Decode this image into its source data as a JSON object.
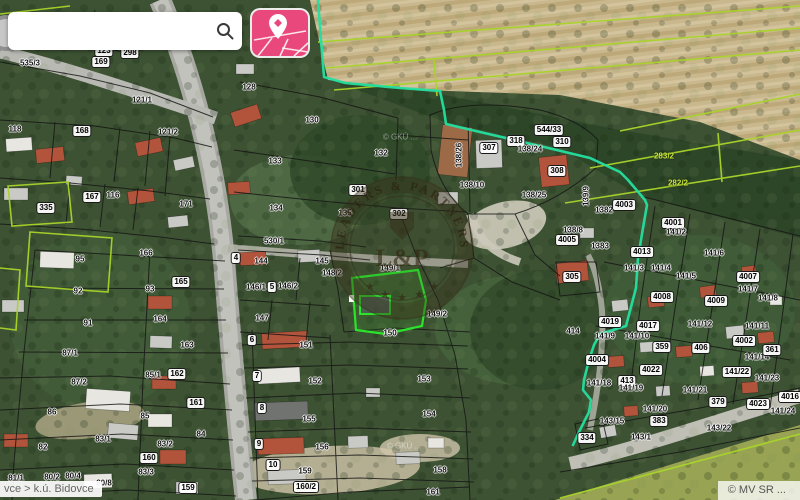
{
  "app": {
    "search": {
      "value": "",
      "icon": "magnifier"
    },
    "map_style_button": {
      "icon": "map-with-location-pin",
      "color": "#e9487d"
    }
  },
  "statusbar": {
    "breadcrumb": "vce > k.ú. Bidovce",
    "copyright": "© MV SR ..."
  },
  "watermark": {
    "arc_text": "LEADERS & PARTNERS",
    "monogram": "L&P",
    "stars": "★"
  },
  "map": {
    "colors": {
      "boundary_cyan": "#24dfa0",
      "field_lines_lime": "#a8d42a",
      "cadastral_black": "#141414",
      "selected_green": "#2be32b",
      "field_tan": "#c9b88e",
      "forest_green": "#2d4527",
      "road_gray": "#b9b9b3"
    },
    "building_colors": {
      "r": "#b2543b",
      "g": "#c9cac6",
      "d": "#70736f",
      "w": "#e7e6e0",
      "br": "#9c6a46"
    },
    "selected_parcel": {
      "label": "149/1"
    },
    "labels": [
      {
        "t": "123",
        "x": 104,
        "y": 51,
        "s": "p"
      },
      {
        "t": "298",
        "x": 130,
        "y": 53,
        "s": "p"
      },
      {
        "t": "169",
        "x": 101,
        "y": 62,
        "s": "p"
      },
      {
        "t": "535/3",
        "x": 30,
        "y": 63,
        "s": "h"
      },
      {
        "t": "128",
        "x": 249,
        "y": 87,
        "s": "h"
      },
      {
        "t": "121/1",
        "x": 142,
        "y": 100,
        "s": "h"
      },
      {
        "t": "118",
        "x": 15,
        "y": 129,
        "s": "h"
      },
      {
        "t": "168",
        "x": 82,
        "y": 131,
        "s": "p"
      },
      {
        "t": "121/2",
        "x": 168,
        "y": 132,
        "s": "h"
      },
      {
        "t": "130",
        "x": 312,
        "y": 120,
        "s": "h"
      },
      {
        "t": "132",
        "x": 381,
        "y": 153,
        "s": "h"
      },
      {
        "t": "133",
        "x": 275,
        "y": 161,
        "s": "h"
      },
      {
        "t": "167",
        "x": 92,
        "y": 197,
        "s": "p"
      },
      {
        "t": "116",
        "x": 113,
        "y": 195,
        "s": "h"
      },
      {
        "t": "335",
        "x": 46,
        "y": 208,
        "s": "p"
      },
      {
        "t": "171",
        "x": 186,
        "y": 204,
        "s": "h"
      },
      {
        "t": "301",
        "x": 358,
        "y": 190,
        "s": "p"
      },
      {
        "t": "302",
        "x": 399,
        "y": 214,
        "s": "p"
      },
      {
        "t": "95",
        "x": 80,
        "y": 259,
        "s": "h"
      },
      {
        "t": "166",
        "x": 146,
        "y": 253,
        "s": "h"
      },
      {
        "t": "92",
        "x": 78,
        "y": 291,
        "s": "h"
      },
      {
        "t": "93",
        "x": 150,
        "y": 289,
        "s": "h"
      },
      {
        "t": "165",
        "x": 181,
        "y": 282,
        "s": "p"
      },
      {
        "t": "164",
        "x": 160,
        "y": 319,
        "s": "h"
      },
      {
        "t": "91",
        "x": 88,
        "y": 323,
        "s": "h"
      },
      {
        "t": "163",
        "x": 187,
        "y": 345,
        "s": "h"
      },
      {
        "t": "87/1",
        "x": 70,
        "y": 353,
        "s": "h"
      },
      {
        "t": "85/1",
        "x": 153,
        "y": 375,
        "s": "h"
      },
      {
        "t": "162",
        "x": 177,
        "y": 374,
        "s": "p"
      },
      {
        "t": "87/2",
        "x": 79,
        "y": 382,
        "s": "h"
      },
      {
        "t": "86",
        "x": 52,
        "y": 412,
        "s": "h"
      },
      {
        "t": "85",
        "x": 145,
        "y": 416,
        "s": "h"
      },
      {
        "t": "161",
        "x": 196,
        "y": 403,
        "s": "p"
      },
      {
        "t": "82",
        "x": 43,
        "y": 447,
        "s": "h"
      },
      {
        "t": "83/1",
        "x": 103,
        "y": 439,
        "s": "h"
      },
      {
        "t": "83/2",
        "x": 165,
        "y": 444,
        "s": "h"
      },
      {
        "t": "84",
        "x": 201,
        "y": 434,
        "s": "h"
      },
      {
        "t": "160",
        "x": 149,
        "y": 458,
        "s": "p"
      },
      {
        "t": "81/1",
        "x": 16,
        "y": 478,
        "s": "h"
      },
      {
        "t": "80/2",
        "x": 52,
        "y": 477,
        "s": "h"
      },
      {
        "t": "80/4",
        "x": 73,
        "y": 476,
        "s": "h"
      },
      {
        "t": "80/8",
        "x": 104,
        "y": 483,
        "s": "h"
      },
      {
        "t": "83/3",
        "x": 146,
        "y": 472,
        "s": "h"
      },
      {
        "t": "159",
        "x": 188,
        "y": 488,
        "s": "p"
      },
      {
        "t": "134",
        "x": 276,
        "y": 208,
        "s": "h"
      },
      {
        "t": "135",
        "x": 345,
        "y": 213,
        "s": "h"
      },
      {
        "t": "530/1",
        "x": 274,
        "y": 241,
        "s": "h"
      },
      {
        "t": "144",
        "x": 261,
        "y": 261,
        "s": "h"
      },
      {
        "t": "145",
        "x": 322,
        "y": 261,
        "s": "h"
      },
      {
        "t": "4",
        "x": 236,
        "y": 258,
        "s": "p"
      },
      {
        "t": "5",
        "x": 272,
        "y": 287,
        "s": "p"
      },
      {
        "t": "148/2",
        "x": 332,
        "y": 273,
        "s": "h"
      },
      {
        "t": "146/1",
        "x": 256,
        "y": 287,
        "s": "h"
      },
      {
        "t": "146/2",
        "x": 288,
        "y": 286,
        "s": "h"
      },
      {
        "t": "147",
        "x": 262,
        "y": 318,
        "s": "h"
      },
      {
        "t": "149/1",
        "x": 390,
        "y": 268,
        "s": "h"
      },
      {
        "t": "149/2",
        "x": 437,
        "y": 314,
        "s": "h"
      },
      {
        "t": "150",
        "x": 390,
        "y": 333,
        "s": "h"
      },
      {
        "t": "151",
        "x": 306,
        "y": 345,
        "s": "h"
      },
      {
        "t": "152",
        "x": 315,
        "y": 381,
        "s": "h"
      },
      {
        "t": "153",
        "x": 424,
        "y": 379,
        "s": "h"
      },
      {
        "t": "155",
        "x": 309,
        "y": 419,
        "s": "h"
      },
      {
        "t": "154",
        "x": 429,
        "y": 414,
        "s": "h"
      },
      {
        "t": "156",
        "x": 322,
        "y": 447,
        "s": "h"
      },
      {
        "t": "159",
        "x": 305,
        "y": 471,
        "s": "h"
      },
      {
        "t": "158",
        "x": 440,
        "y": 470,
        "s": "h"
      },
      {
        "t": "160/2",
        "x": 306,
        "y": 487,
        "s": "p"
      },
      {
        "t": "161",
        "x": 433,
        "y": 492,
        "s": "h"
      },
      {
        "t": "6",
        "x": 252,
        "y": 340,
        "s": "p"
      },
      {
        "t": "7",
        "x": 257,
        "y": 376,
        "s": "p"
      },
      {
        "t": "8",
        "x": 262,
        "y": 408,
        "s": "p"
      },
      {
        "t": "9",
        "x": 259,
        "y": 444,
        "s": "p"
      },
      {
        "t": "10",
        "x": 273,
        "y": 465,
        "s": "p"
      },
      {
        "t": "138/26",
        "x": 459,
        "y": 155,
        "s": "v"
      },
      {
        "t": "307",
        "x": 489,
        "y": 148,
        "s": "p"
      },
      {
        "t": "318",
        "x": 516,
        "y": 141,
        "s": "p"
      },
      {
        "t": "544/33",
        "x": 549,
        "y": 130,
        "s": "p"
      },
      {
        "t": "138/24",
        "x": 530,
        "y": 149,
        "s": "h"
      },
      {
        "t": "310",
        "x": 562,
        "y": 142,
        "s": "p"
      },
      {
        "t": "308",
        "x": 557,
        "y": 171,
        "s": "p"
      },
      {
        "t": "138/10",
        "x": 472,
        "y": 185,
        "s": "h"
      },
      {
        "t": "138/25",
        "x": 534,
        "y": 195,
        "s": "h"
      },
      {
        "t": "139/9",
        "x": 586,
        "y": 196,
        "s": "v"
      },
      {
        "t": "1382",
        "x": 604,
        "y": 210,
        "s": "h"
      },
      {
        "t": "4003",
        "x": 624,
        "y": 205,
        "s": "p"
      },
      {
        "t": "4001",
        "x": 673,
        "y": 223,
        "s": "p"
      },
      {
        "t": "141/2",
        "x": 676,
        "y": 232,
        "s": "h"
      },
      {
        "t": "138/8",
        "x": 573,
        "y": 230,
        "s": "h"
      },
      {
        "t": "4005",
        "x": 567,
        "y": 240,
        "s": "p"
      },
      {
        "t": "1383",
        "x": 600,
        "y": 246,
        "s": "h"
      },
      {
        "t": "4013",
        "x": 642,
        "y": 252,
        "s": "p"
      },
      {
        "t": "141/3",
        "x": 634,
        "y": 268,
        "s": "h"
      },
      {
        "t": "141/4",
        "x": 661,
        "y": 268,
        "s": "h"
      },
      {
        "t": "141/5",
        "x": 686,
        "y": 276,
        "s": "h"
      },
      {
        "t": "141/6",
        "x": 714,
        "y": 253,
        "s": "h"
      },
      {
        "t": "4007",
        "x": 748,
        "y": 277,
        "s": "p"
      },
      {
        "t": "141/7",
        "x": 748,
        "y": 289,
        "s": "h"
      },
      {
        "t": "4008",
        "x": 662,
        "y": 297,
        "s": "p"
      },
      {
        "t": "4009",
        "x": 716,
        "y": 301,
        "s": "p"
      },
      {
        "t": "305",
        "x": 572,
        "y": 277,
        "s": "p"
      },
      {
        "t": "283/2",
        "x": 664,
        "y": 156,
        "s": "l"
      },
      {
        "t": "282/2",
        "x": 678,
        "y": 183,
        "s": "l"
      },
      {
        "t": "141/8",
        "x": 768,
        "y": 298,
        "s": "h"
      },
      {
        "t": "4019",
        "x": 610,
        "y": 322,
        "s": "p"
      },
      {
        "t": "4017",
        "x": 648,
        "y": 326,
        "s": "p"
      },
      {
        "t": "141/12",
        "x": 700,
        "y": 324,
        "s": "h"
      },
      {
        "t": "141/11",
        "x": 757,
        "y": 326,
        "s": "h"
      },
      {
        "t": "141/9",
        "x": 605,
        "y": 336,
        "s": "h"
      },
      {
        "t": "141/10",
        "x": 637,
        "y": 336,
        "s": "h"
      },
      {
        "t": "359",
        "x": 662,
        "y": 347,
        "s": "p"
      },
      {
        "t": "406",
        "x": 701,
        "y": 348,
        "s": "p"
      },
      {
        "t": "4002",
        "x": 744,
        "y": 341,
        "s": "p"
      },
      {
        "t": "141/14",
        "x": 757,
        "y": 357,
        "s": "h"
      },
      {
        "t": "361",
        "x": 772,
        "y": 350,
        "s": "p"
      },
      {
        "t": "4004",
        "x": 597,
        "y": 360,
        "s": "p"
      },
      {
        "t": "4022",
        "x": 651,
        "y": 370,
        "s": "p"
      },
      {
        "t": "413",
        "x": 627,
        "y": 381,
        "s": "p"
      },
      {
        "t": "141/18",
        "x": 599,
        "y": 383,
        "s": "h"
      },
      {
        "t": "141/19",
        "x": 631,
        "y": 388,
        "s": "h"
      },
      {
        "t": "141/22",
        "x": 737,
        "y": 372,
        "s": "p"
      },
      {
        "t": "141/23",
        "x": 767,
        "y": 378,
        "s": "h"
      },
      {
        "t": "141/21",
        "x": 695,
        "y": 390,
        "s": "h"
      },
      {
        "t": "379",
        "x": 718,
        "y": 402,
        "s": "p"
      },
      {
        "t": "4023",
        "x": 758,
        "y": 404,
        "s": "p"
      },
      {
        "t": "141/24",
        "x": 783,
        "y": 411,
        "s": "h"
      },
      {
        "t": "4016",
        "x": 790,
        "y": 397,
        "s": "p"
      },
      {
        "t": "141/20",
        "x": 655,
        "y": 409,
        "s": "h"
      },
      {
        "t": "143/15",
        "x": 612,
        "y": 421,
        "s": "h"
      },
      {
        "t": "383",
        "x": 659,
        "y": 421,
        "s": "p"
      },
      {
        "t": "143/1",
        "x": 641,
        "y": 437,
        "s": "h"
      },
      {
        "t": "143/22",
        "x": 719,
        "y": 428,
        "s": "h"
      },
      {
        "t": "334",
        "x": 587,
        "y": 438,
        "s": "p"
      },
      {
        "t": "414",
        "x": 573,
        "y": 331,
        "s": "h"
      },
      {
        "t": "© GKÚ ...",
        "x": 400,
        "y": 137,
        "s": "c"
      },
      {
        "t": "© GKÚ ...",
        "x": 404,
        "y": 446,
        "s": "c"
      }
    ],
    "buildings": [
      {
        "x": 6,
        "y": 138,
        "w": 26,
        "h": 13,
        "rot": -4,
        "c": "w"
      },
      {
        "x": 36,
        "y": 148,
        "w": 28,
        "h": 14,
        "rot": -6,
        "c": "r"
      },
      {
        "x": 4,
        "y": 188,
        "w": 24,
        "h": 12,
        "rot": 0,
        "c": "g"
      },
      {
        "x": 66,
        "y": 176,
        "w": 16,
        "h": 9,
        "rot": 4,
        "c": "g"
      },
      {
        "x": 136,
        "y": 140,
        "w": 26,
        "h": 14,
        "rot": -12,
        "c": "r"
      },
      {
        "x": 174,
        "y": 158,
        "w": 20,
        "h": 11,
        "rot": -12,
        "c": "g"
      },
      {
        "x": 128,
        "y": 190,
        "w": 26,
        "h": 13,
        "rot": -8,
        "c": "r"
      },
      {
        "x": 168,
        "y": 216,
        "w": 20,
        "h": 11,
        "rot": -6,
        "c": "g"
      },
      {
        "x": 40,
        "y": 252,
        "w": 34,
        "h": 16,
        "rot": 2,
        "c": "w"
      },
      {
        "x": 2,
        "y": 300,
        "w": 22,
        "h": 12,
        "rot": 0,
        "c": "g"
      },
      {
        "x": 148,
        "y": 296,
        "w": 24,
        "h": 13,
        "rot": 0,
        "c": "r"
      },
      {
        "x": 150,
        "y": 336,
        "w": 22,
        "h": 12,
        "rot": 2,
        "c": "g"
      },
      {
        "x": 86,
        "y": 390,
        "w": 44,
        "h": 20,
        "rot": 4,
        "c": "w"
      },
      {
        "x": 108,
        "y": 424,
        "w": 30,
        "h": 15,
        "rot": 5,
        "c": "g"
      },
      {
        "x": 4,
        "y": 434,
        "w": 24,
        "h": 13,
        "rot": 0,
        "c": "r"
      },
      {
        "x": 152,
        "y": 376,
        "w": 24,
        "h": 13,
        "rot": 0,
        "c": "r"
      },
      {
        "x": 148,
        "y": 414,
        "w": 24,
        "h": 13,
        "rot": 0,
        "c": "w"
      },
      {
        "x": 160,
        "y": 450,
        "w": 26,
        "h": 14,
        "rot": 0,
        "c": "r"
      },
      {
        "x": 176,
        "y": 482,
        "w": 22,
        "h": 12,
        "rot": 0,
        "c": "g"
      },
      {
        "x": 84,
        "y": 474,
        "w": 28,
        "h": 14,
        "rot": -2,
        "c": "w"
      },
      {
        "x": 232,
        "y": 108,
        "w": 28,
        "h": 15,
        "rot": -18,
        "c": "r"
      },
      {
        "x": 228,
        "y": 182,
        "w": 22,
        "h": 12,
        "rot": -4,
        "c": "r"
      },
      {
        "x": 240,
        "y": 252,
        "w": 26,
        "h": 13,
        "rot": -3,
        "c": "r"
      },
      {
        "x": 298,
        "y": 250,
        "w": 22,
        "h": 12,
        "rot": -3,
        "c": "g"
      },
      {
        "x": 236,
        "y": 64,
        "w": 18,
        "h": 10,
        "rot": 0,
        "c": "g"
      },
      {
        "x": 262,
        "y": 332,
        "w": 46,
        "h": 16,
        "rot": -3,
        "c": "r"
      },
      {
        "x": 258,
        "y": 368,
        "w": 42,
        "h": 15,
        "rot": -3,
        "c": "w"
      },
      {
        "x": 254,
        "y": 402,
        "w": 54,
        "h": 18,
        "rot": -2,
        "c": "d"
      },
      {
        "x": 258,
        "y": 438,
        "w": 46,
        "h": 16,
        "rot": -2,
        "c": "r"
      },
      {
        "x": 268,
        "y": 470,
        "w": 38,
        "h": 14,
        "rot": -2,
        "c": "g"
      },
      {
        "x": 440,
        "y": 126,
        "w": 30,
        "h": 50,
        "rot": 6,
        "c": "br"
      },
      {
        "x": 476,
        "y": 140,
        "w": 26,
        "h": 28,
        "rot": -2,
        "c": "g"
      },
      {
        "x": 540,
        "y": 156,
        "w": 28,
        "h": 30,
        "rot": -6,
        "c": "r"
      },
      {
        "x": 438,
        "y": 192,
        "w": 20,
        "h": 12,
        "rot": 0,
        "c": "g"
      },
      {
        "x": 556,
        "y": 262,
        "w": 32,
        "h": 20,
        "rot": -6,
        "c": "r"
      },
      {
        "x": 580,
        "y": 228,
        "w": 14,
        "h": 10,
        "rot": 0,
        "c": "g"
      },
      {
        "x": 612,
        "y": 300,
        "w": 16,
        "h": 11,
        "rot": -6,
        "c": "g"
      },
      {
        "x": 648,
        "y": 296,
        "w": 16,
        "h": 11,
        "rot": -6,
        "c": "r"
      },
      {
        "x": 700,
        "y": 286,
        "w": 16,
        "h": 11,
        "rot": -8,
        "c": "r"
      },
      {
        "x": 742,
        "y": 266,
        "w": 14,
        "h": 10,
        "rot": -8,
        "c": "r"
      },
      {
        "x": 726,
        "y": 326,
        "w": 18,
        "h": 12,
        "rot": -6,
        "c": "g"
      },
      {
        "x": 758,
        "y": 332,
        "w": 16,
        "h": 11,
        "rot": -6,
        "c": "r"
      },
      {
        "x": 676,
        "y": 346,
        "w": 16,
        "h": 11,
        "rot": -4,
        "c": "r"
      },
      {
        "x": 640,
        "y": 342,
        "w": 14,
        "h": 10,
        "rot": -4,
        "c": "g"
      },
      {
        "x": 608,
        "y": 356,
        "w": 16,
        "h": 11,
        "rot": -4,
        "c": "r"
      },
      {
        "x": 700,
        "y": 366,
        "w": 14,
        "h": 10,
        "rot": -4,
        "c": "w"
      },
      {
        "x": 742,
        "y": 382,
        "w": 16,
        "h": 11,
        "rot": -4,
        "c": "r"
      },
      {
        "x": 656,
        "y": 386,
        "w": 14,
        "h": 10,
        "rot": -4,
        "c": "g"
      },
      {
        "x": 624,
        "y": 406,
        "w": 14,
        "h": 10,
        "rot": -4,
        "c": "r"
      },
      {
        "x": 600,
        "y": 426,
        "w": 16,
        "h": 11,
        "rot": -10,
        "c": "g"
      },
      {
        "x": 770,
        "y": 296,
        "w": 12,
        "h": 9,
        "rot": 0,
        "c": "w"
      },
      {
        "x": 348,
        "y": 436,
        "w": 20,
        "h": 12,
        "rot": -2,
        "c": "g"
      },
      {
        "x": 396,
        "y": 452,
        "w": 24,
        "h": 12,
        "rot": -2,
        "c": "g"
      },
      {
        "x": 428,
        "y": 438,
        "w": 16,
        "h": 10,
        "rot": 0,
        "c": "w"
      },
      {
        "x": 366,
        "y": 388,
        "w": 14,
        "h": 9,
        "rot": 0,
        "c": "g"
      }
    ]
  }
}
